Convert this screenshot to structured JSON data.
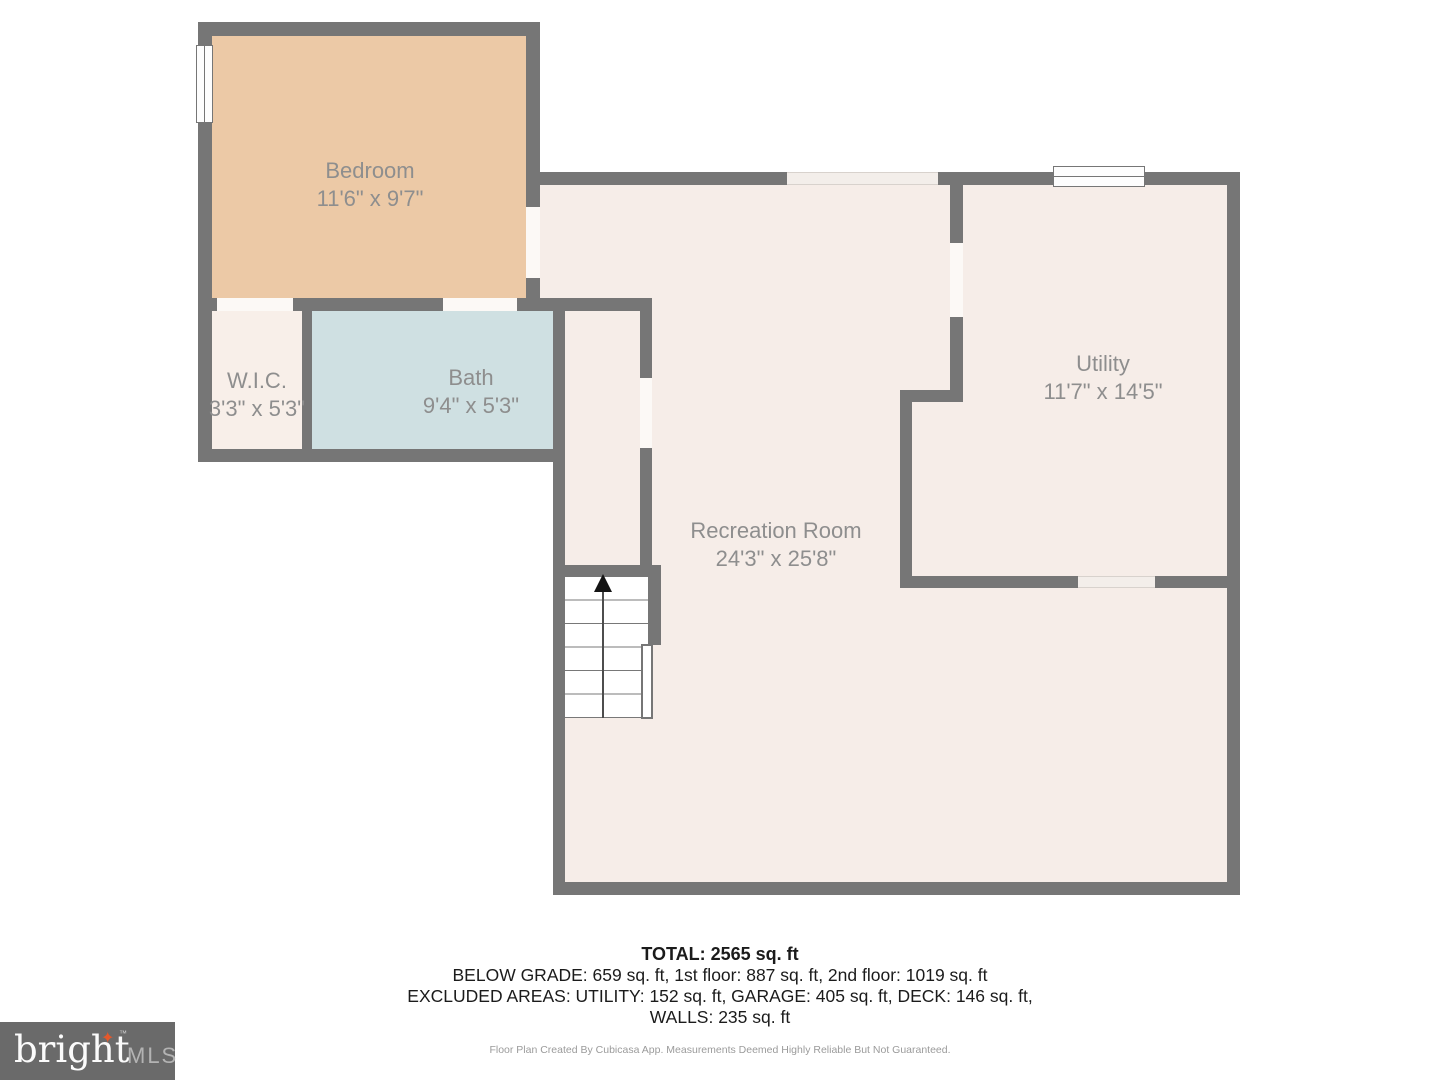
{
  "rooms": [
    {
      "name": "Bedroom",
      "dims": "11'6\" x 9'7\""
    },
    {
      "name": "W.I.C.",
      "dims": "3'3\" x 5'3\""
    },
    {
      "name": "Bath",
      "dims": "9'4\" x 5'3\""
    },
    {
      "name": "Recreation Room",
      "dims": "24'3\" x 25'8\""
    },
    {
      "name": "Utility",
      "dims": "11'7\" x 14'5\""
    }
  ],
  "summary": {
    "total": "TOTAL: 2565 sq. ft",
    "line2": "BELOW GRADE: 659 sq. ft, 1st floor: 887 sq. ft, 2nd floor: 1019 sq. ft",
    "line3": "EXCLUDED AREAS: UTILITY: 152 sq. ft, GARAGE: 405 sq. ft, DECK: 146 sq. ft,",
    "line4": "WALLS: 235 sq. ft"
  },
  "footer": {
    "disclaimer": "Floor Plan Created By Cubicasa App. Measurements Deemed Highly Reliable But Not Guaranteed."
  },
  "logo": {
    "brand": "bright",
    "star": "✦",
    "tm": "™",
    "suffix": "MLS"
  },
  "colors": {
    "wall": "#767676",
    "bedroom_floor": "#ecc9a6",
    "bath_floor": "#cfe0e2",
    "floor": "#f6ede8",
    "wic_floor": "#f8efe9",
    "background": "#ffffff",
    "label_text": "#8e8e8e",
    "logo_background": "#6a6a6a",
    "logo_accent": "#e4582b"
  }
}
